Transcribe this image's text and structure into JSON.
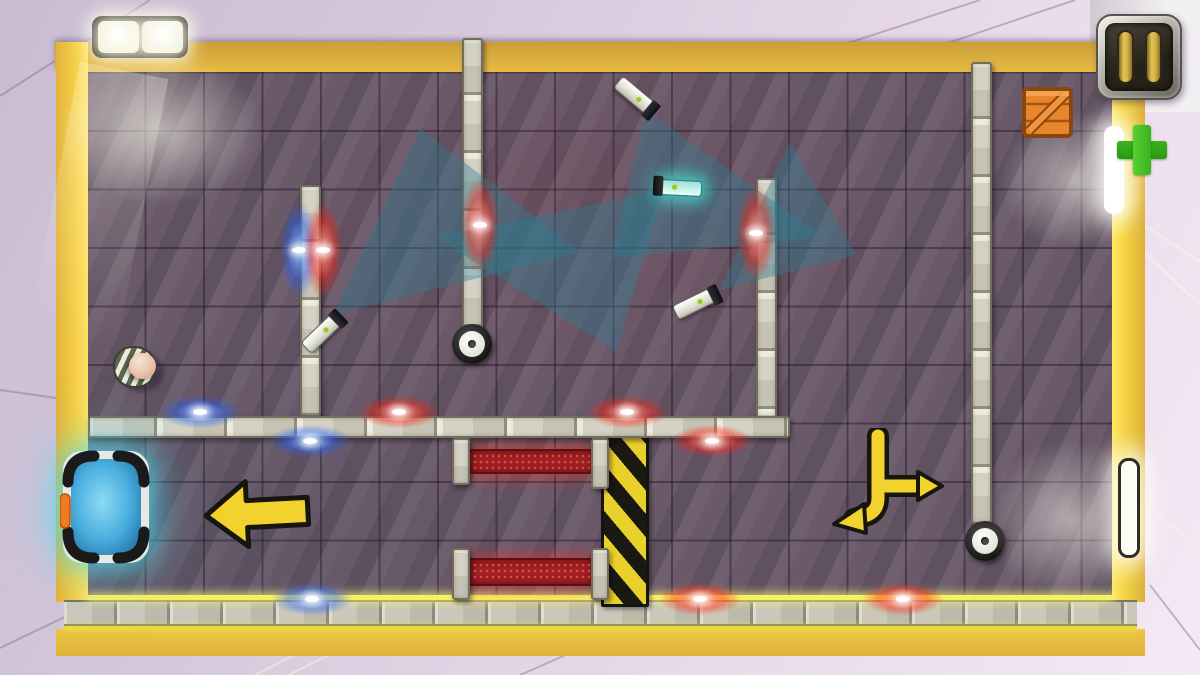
{
  "hud": {
    "pause_button": {
      "icon": "pause-icon"
    },
    "crate_slot": {
      "icon": "crate-icon"
    },
    "plus_button": {
      "icon": "plus-icon"
    }
  },
  "colors": {
    "floor-base": "#6a5969",
    "frame-yellow": "#f2c33c",
    "wall-gray": "#d5d2c5",
    "cone-teal": "#2c7e92",
    "hazard-yellow": "#e9d02b",
    "carpet-red": "#a32024",
    "glow-red": "#ff1e0f",
    "glow-blue": "#1e5aff",
    "arrow-yellow": "#f2d22c",
    "portal-cyan": "#46dcf0",
    "plus-green": "#3bb31c",
    "crate-orange": "#e8862c"
  },
  "scene": {
    "walls": [
      {
        "id": "wall-left",
        "x": 300,
        "y": 185,
        "w": 21,
        "h": 232,
        "dir": "v"
      },
      {
        "id": "wall-center",
        "x": 462,
        "y": 38,
        "w": 21,
        "h": 292,
        "dir": "v"
      },
      {
        "id": "wall-mid-right",
        "x": 756,
        "y": 178,
        "w": 21,
        "h": 240,
        "dir": "v"
      },
      {
        "id": "wall-far-right",
        "x": 971,
        "y": 62,
        "w": 21,
        "h": 462,
        "dir": "v"
      },
      {
        "id": "wall-horizontal",
        "x": 88,
        "y": 416,
        "w": 702,
        "h": 22,
        "dir": "h"
      },
      {
        "id": "post-1",
        "x": 452,
        "y": 438,
        "w": 18,
        "h": 47,
        "dir": "v"
      },
      {
        "id": "post-2",
        "x": 591,
        "y": 438,
        "w": 18,
        "h": 51,
        "dir": "v"
      },
      {
        "id": "post-3",
        "x": 452,
        "y": 548,
        "w": 18,
        "h": 52,
        "dir": "v"
      },
      {
        "id": "post-4",
        "x": 591,
        "y": 548,
        "w": 18,
        "h": 52,
        "dir": "v"
      }
    ],
    "carpets": [
      {
        "x": 468,
        "y": 449,
        "w": 126,
        "h": 25
      },
      {
        "x": 468,
        "y": 558,
        "w": 126,
        "h": 28
      }
    ],
    "hazard": {
      "x": 601,
      "y": 429,
      "w": 48,
      "h": 178
    },
    "cones": [
      "333,315 420,128 580,252",
      "646,110 612,258 823,237",
      "663,190 435,237 617,352",
      "719,290 790,142 856,255"
    ],
    "cameras": [
      {
        "x": 634,
        "y": 95,
        "rot": 40,
        "glow": false
      },
      {
        "x": 681,
        "y": 188,
        "rot": 183,
        "glow": true
      },
      {
        "x": 694,
        "y": 304,
        "rot": -26,
        "glow": false
      },
      {
        "x": 321,
        "y": 334,
        "rot": -44,
        "glow": false
      }
    ],
    "wheels": [
      {
        "x": 472,
        "y": 344
      },
      {
        "x": 985,
        "y": 541
      }
    ],
    "leds": [
      {
        "x": 299,
        "y": 250,
        "c": "blue",
        "o": "v"
      },
      {
        "x": 323,
        "y": 250,
        "c": "red",
        "o": "v"
      },
      {
        "x": 480,
        "y": 225,
        "c": "red",
        "o": "v"
      },
      {
        "x": 756,
        "y": 233,
        "c": "red",
        "o": "v"
      },
      {
        "x": 200,
        "y": 412,
        "c": "blue",
        "o": "h"
      },
      {
        "x": 399,
        "y": 412,
        "c": "red",
        "o": "h"
      },
      {
        "x": 627,
        "y": 412,
        "c": "red",
        "o": "h"
      },
      {
        "x": 310,
        "y": 441,
        "c": "blue",
        "o": "h"
      },
      {
        "x": 712,
        "y": 441,
        "c": "red",
        "o": "h"
      },
      {
        "x": 312,
        "y": 599,
        "c": "blue",
        "o": "h"
      },
      {
        "x": 700,
        "y": 599,
        "c": "red",
        "o": "h"
      },
      {
        "x": 903,
        "y": 599,
        "c": "red",
        "o": "h"
      }
    ]
  }
}
